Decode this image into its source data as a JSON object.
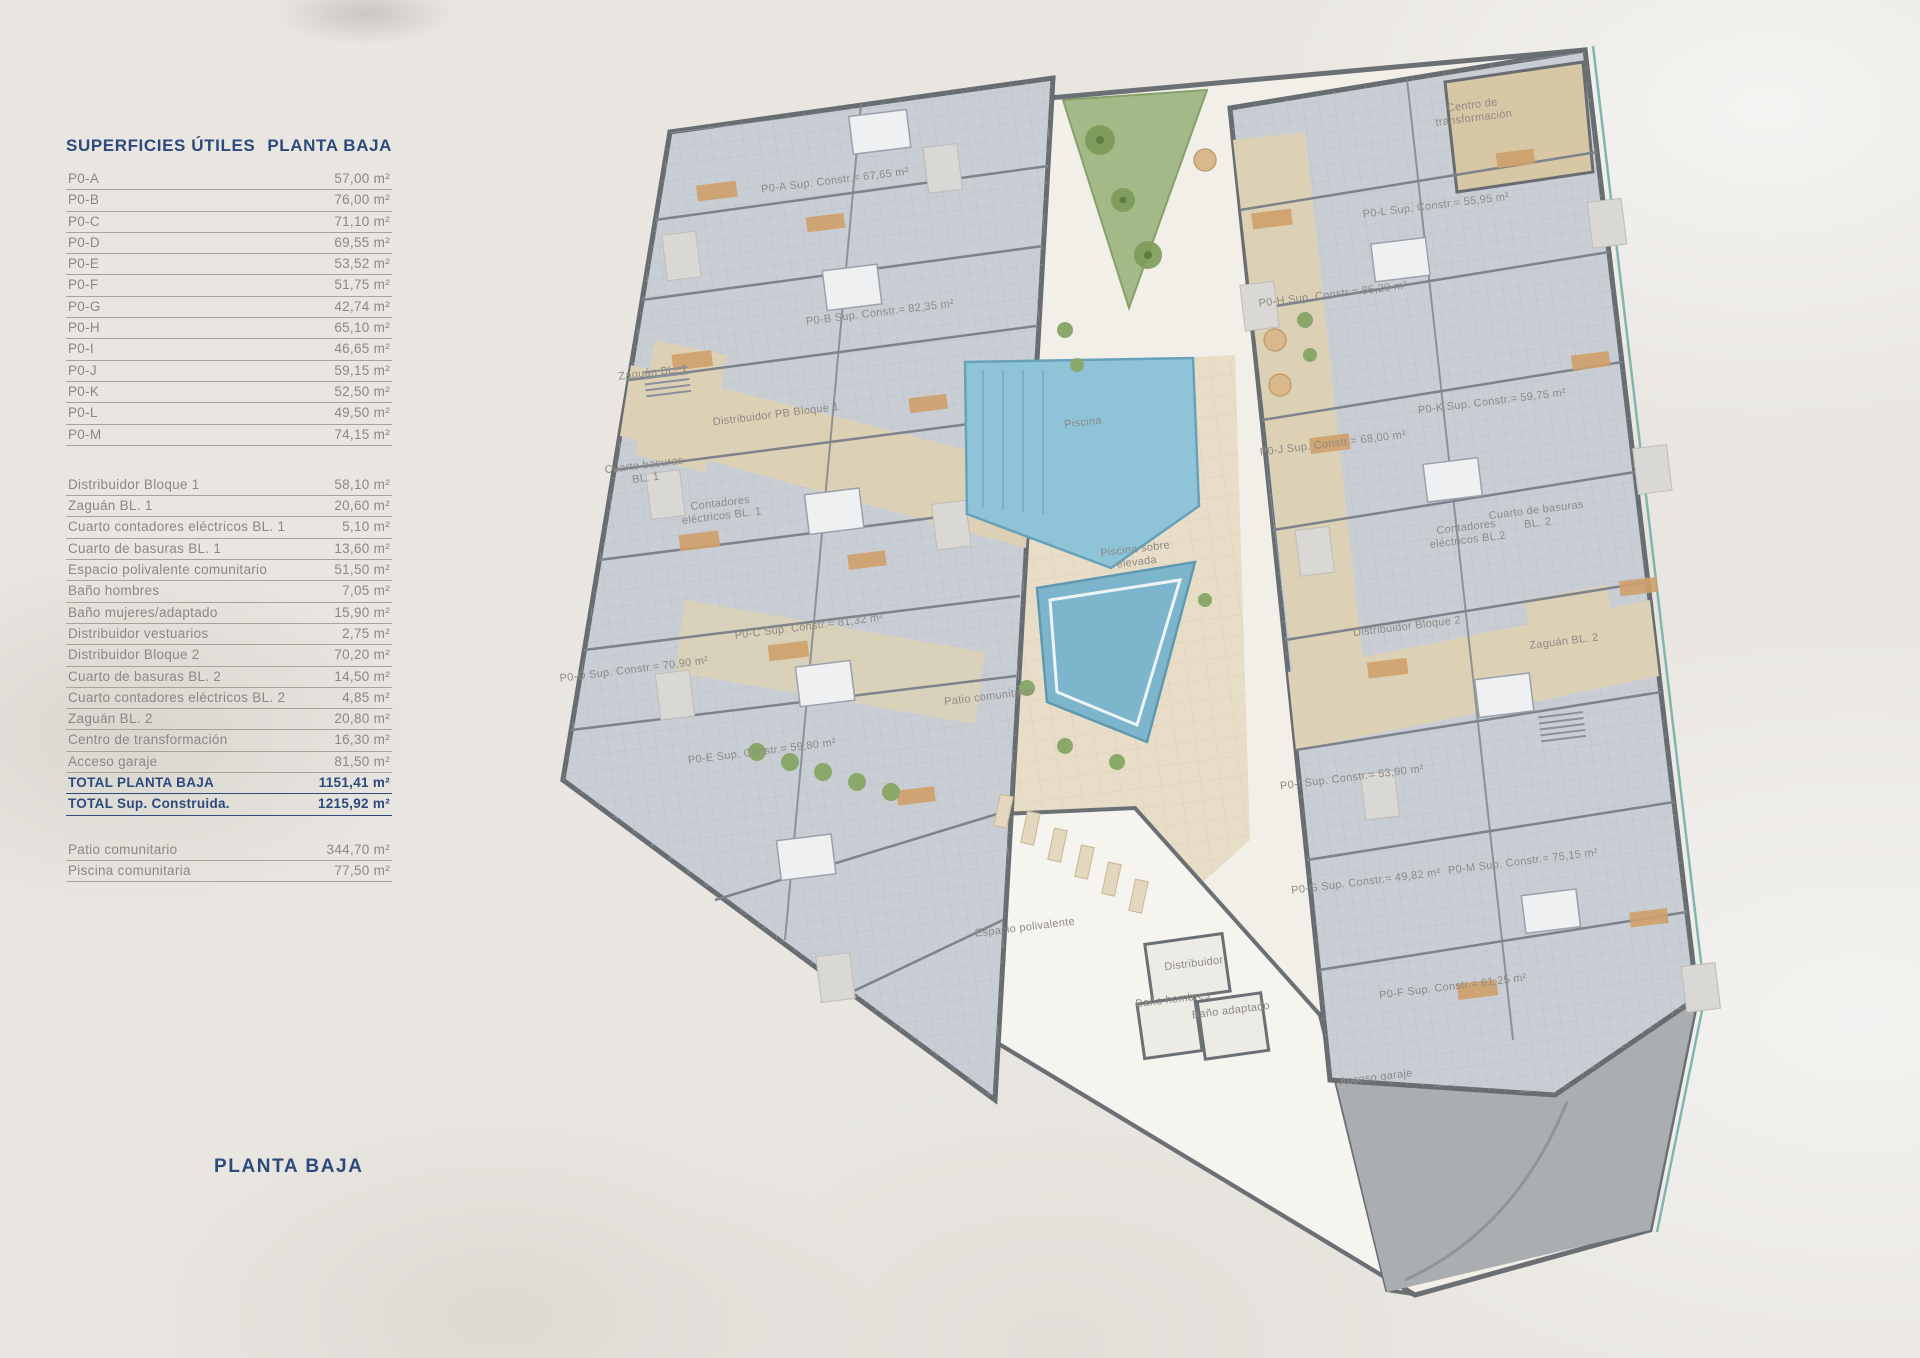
{
  "titles": {
    "table_left": "SUPERFICIES ÚTILES",
    "table_right": "PLANTA BAJA",
    "bottom": "PLANTA BAJA"
  },
  "surfaces": {
    "units": [
      {
        "name": "P0-A",
        "area": "57,00 m²"
      },
      {
        "name": "P0-B",
        "area": "76,00 m²"
      },
      {
        "name": "P0-C",
        "area": "71,10 m²"
      },
      {
        "name": "P0-D",
        "area": "69,55 m²"
      },
      {
        "name": "P0-E",
        "area": "53,52 m²"
      },
      {
        "name": "P0-F",
        "area": "51,75 m²"
      },
      {
        "name": "P0-G",
        "area": "42,74 m²"
      },
      {
        "name": "P0-H",
        "area": "65,10 m²"
      },
      {
        "name": "P0-I",
        "area": "46,65 m²"
      },
      {
        "name": "P0-J",
        "area": "59,15 m²"
      },
      {
        "name": "P0-K",
        "area": "52,50 m²"
      },
      {
        "name": "P0-L",
        "area": "49,50 m²"
      },
      {
        "name": "P0-M",
        "area": "74,15 m²"
      }
    ],
    "common": [
      {
        "name": "Distribuidor Bloque 1",
        "area": "58,10 m²"
      },
      {
        "name": "Zaguán BL. 1",
        "area": "20,60 m²"
      },
      {
        "name": "Cuarto contadores eléctricos BL. 1",
        "area": "5,10 m²"
      },
      {
        "name": "Cuarto de basuras BL. 1",
        "area": "13,60 m²"
      },
      {
        "name": "Espacio polivalente comunitario",
        "area": "51,50 m²"
      },
      {
        "name": "Baño hombres",
        "area": "7,05 m²"
      },
      {
        "name": "Baño mujeres/adaptado",
        "area": "15,90 m²"
      },
      {
        "name": "Distribuidor vestuarios",
        "area": "2,75 m²"
      },
      {
        "name": "Distribuidor Bloque 2",
        "area": "70,20 m²"
      },
      {
        "name": "Cuarto de basuras BL. 2",
        "area": "14,50 m²"
      },
      {
        "name": "Cuarto contadores eléctricos BL. 2",
        "area": "4,85 m²"
      },
      {
        "name": "Zaguán BL. 2",
        "area": "20,80 m²"
      },
      {
        "name": "Centro de transformación",
        "area": "16,30 m²"
      },
      {
        "name": "Acceso garaje",
        "area": "81,50 m²"
      }
    ],
    "totals": [
      {
        "name": "TOTAL PLANTA BAJA",
        "area": "1151,41 m²"
      },
      {
        "name": "TOTAL Sup. Construida.",
        "area": "1215,92 m²"
      }
    ],
    "exterior": [
      {
        "name": "Patio comunitario",
        "area": "344,70 m²"
      },
      {
        "name": "Piscina comunitaria",
        "area": "77,50 m²"
      }
    ]
  },
  "plan": {
    "labels": [
      {
        "text": "P0-A Sup. Constr.= 67,65 m²"
      },
      {
        "text": "P0-B Sup. Constr.= 82,35 m²"
      },
      {
        "text": "Distribuidor PB Bloque 1"
      },
      {
        "text": "Zaguán BL. 1"
      },
      {
        "text": "Cuarto basuras BL. 1"
      },
      {
        "text": "Contadores eléctricos BL. 1"
      },
      {
        "text": "P0-C Sup. Constr.= 81,32 m²"
      },
      {
        "text": "P0-D Sup. Constr.= 70,90 m²"
      },
      {
        "text": "P0-E Sup. Constr.= 59,80 m²"
      },
      {
        "text": "Patio comunitario"
      },
      {
        "text": "Piscina"
      },
      {
        "text": "Piscina sobre elevada"
      },
      {
        "text": "Espacio polivalente"
      },
      {
        "text": "Distribuidor"
      },
      {
        "text": "Baño hombres"
      },
      {
        "text": "Baño adaptado"
      },
      {
        "text": "Acceso garaje"
      },
      {
        "text": "Centro de transformación"
      },
      {
        "text": "P0-H Sup. Constr.= 85,20 m²"
      },
      {
        "text": "P0-L Sup. Constr.= 55,95 m²"
      },
      {
        "text": "P0-K Sup. Constr.= 59,75 m²"
      },
      {
        "text": "P0-J Sup. Constr.= 68,00 m²"
      },
      {
        "text": "Cuarto de basuras BL. 2"
      },
      {
        "text": "Contadores eléctricos BL.2"
      },
      {
        "text": "Distribuidor Bloque 2"
      },
      {
        "text": "Zaguán BL. 2"
      },
      {
        "text": "P0-I Sup. Constr.= 53,90 m²"
      },
      {
        "text": "P0-M Sup. Constr.= 75,15 m²"
      },
      {
        "text": "P0-G Sup. Constr.= 49,82 m²"
      },
      {
        "text": "P0-F Sup. Constr.= 61,25 m²"
      }
    ]
  },
  "colors": {
    "accent_navy": "#2c4a7c",
    "row_text_gray": "#8b8884",
    "row_line": "#a8a29a",
    "plan_floor_blue": "#c9ced5",
    "corridor_beige": "#ddd1b5",
    "pool_blue": "#8fc3d8",
    "raised_pool_blue": "#7db6cc",
    "green": "#8ba86b",
    "wall_gray": "#686d71",
    "garage_gray": "#abaeb1",
    "background": "#e9e6e1"
  }
}
